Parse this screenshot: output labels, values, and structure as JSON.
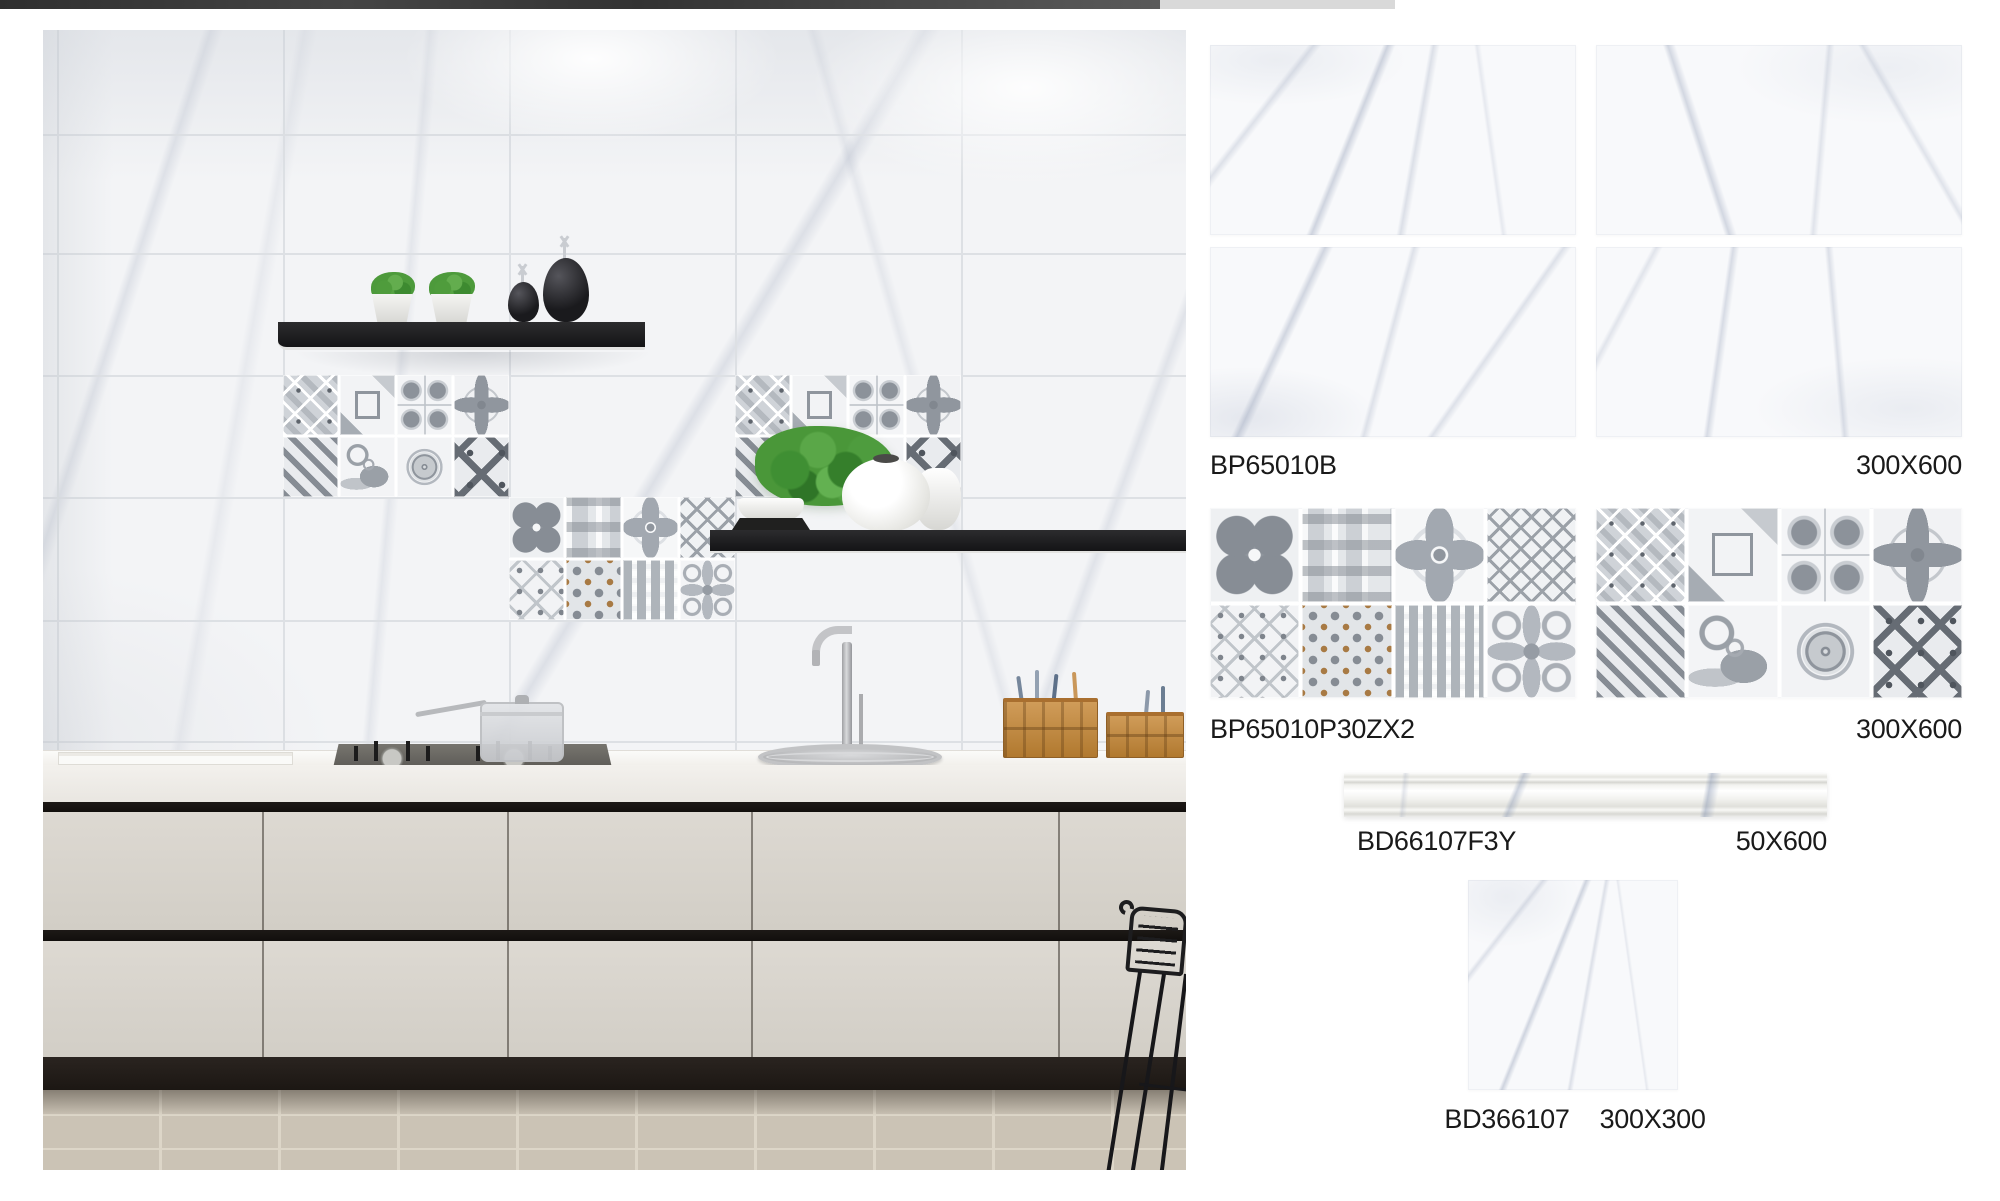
{
  "products": [
    {
      "code": "BP65010B",
      "size": "300X600"
    },
    {
      "code": "BP65010P30ZX2",
      "size": "300X600"
    },
    {
      "code": "BD66107F3Y",
      "size": "50X600"
    },
    {
      "code": "BD366107",
      "size": "300X300"
    }
  ],
  "patterns": {
    "set1": [
      "quatrefoil",
      "blocks",
      "clover",
      "lattice",
      "chain",
      "dots",
      "weave",
      "scroll"
    ],
    "set2": [
      "bevels",
      "frame",
      "medallions",
      "starburst",
      "stripes",
      "paisley",
      "rosette",
      "octagon"
    ]
  },
  "colors": {
    "topbar_dark": "#3a3a3a",
    "topbar_light": "#d9d9d9",
    "wall": "#f3f4f6",
    "grout": "#dde0e4",
    "shelf": "#1a1a1c",
    "cabinet": "#d9d5ce",
    "cabinet_gap": "#171310",
    "floor": "#cbc3b5",
    "label_text": "#1a1a1a"
  }
}
